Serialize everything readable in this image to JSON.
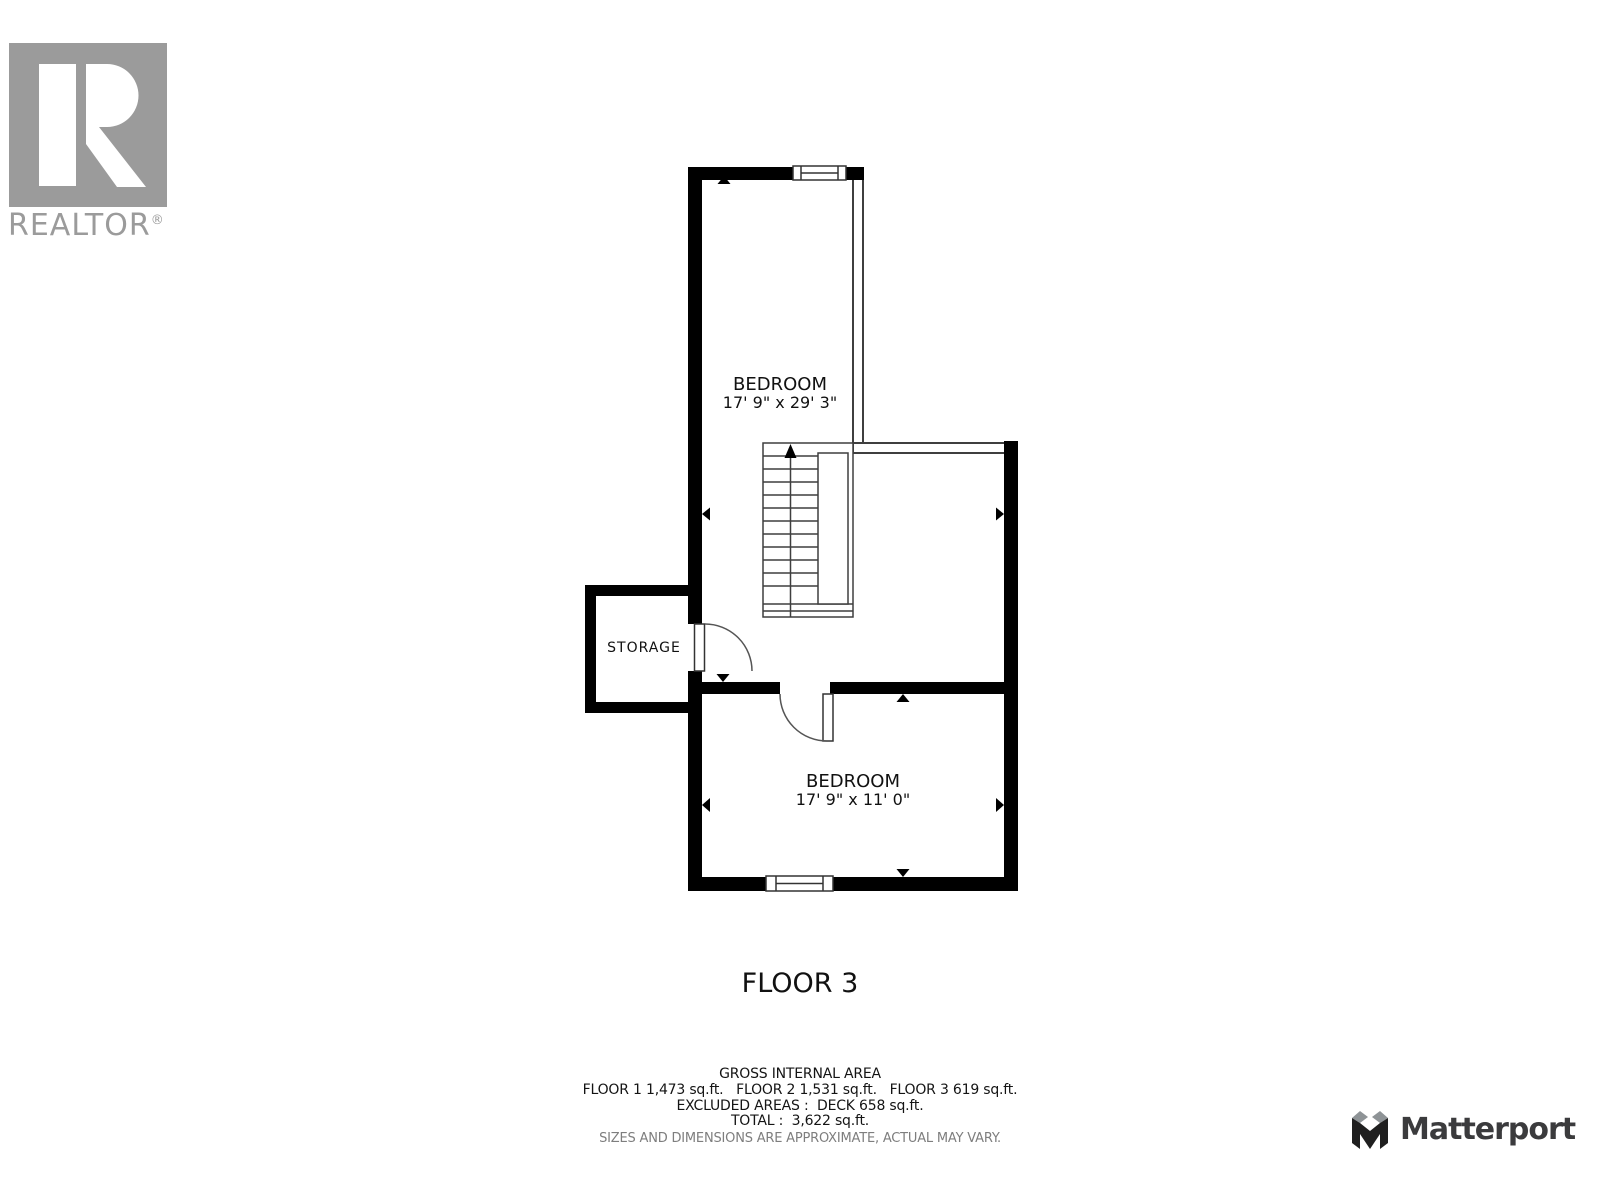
{
  "branding": {
    "realtor": {
      "logo_text": "REALTOR",
      "registered_mark": "®"
    },
    "matterport": {
      "logo_text": "Matterport"
    }
  },
  "floorplan": {
    "floor_label": "FLOOR 3",
    "rooms": [
      {
        "name": "BEDROOM",
        "dimensions": "17' 9\" x 29' 3\""
      },
      {
        "name": "BEDROOM",
        "dimensions": "17' 9\" x 11' 0\""
      },
      {
        "name": "STORAGE",
        "dimensions": ""
      }
    ]
  },
  "area_summary": {
    "title": "GROSS INTERNAL AREA",
    "floor_areas": "FLOOR 1 1,473 sq.ft.   FLOOR 2 1,531 sq.ft.   FLOOR 3 619 sq.ft.",
    "excluded_areas": "EXCLUDED AREAS :  DECK 658 sq.ft.",
    "total": "TOTAL :  3,622 sq.ft.",
    "disclaimer": "SIZES AND DIMENSIONS ARE APPROXIMATE, ACTUAL MAY VARY."
  },
  "colors": {
    "wall_black": "#000000",
    "thin_wall_stroke": "#3f3f3f",
    "realtor_gray": "#9b9b9b",
    "matterport_dark": "#1f1f1f",
    "matterport_gray": "#8e9396",
    "matterport_text": "#3b3b3d",
    "disclaimer_gray": "#7e7e7e",
    "label_text": "#111111"
  }
}
